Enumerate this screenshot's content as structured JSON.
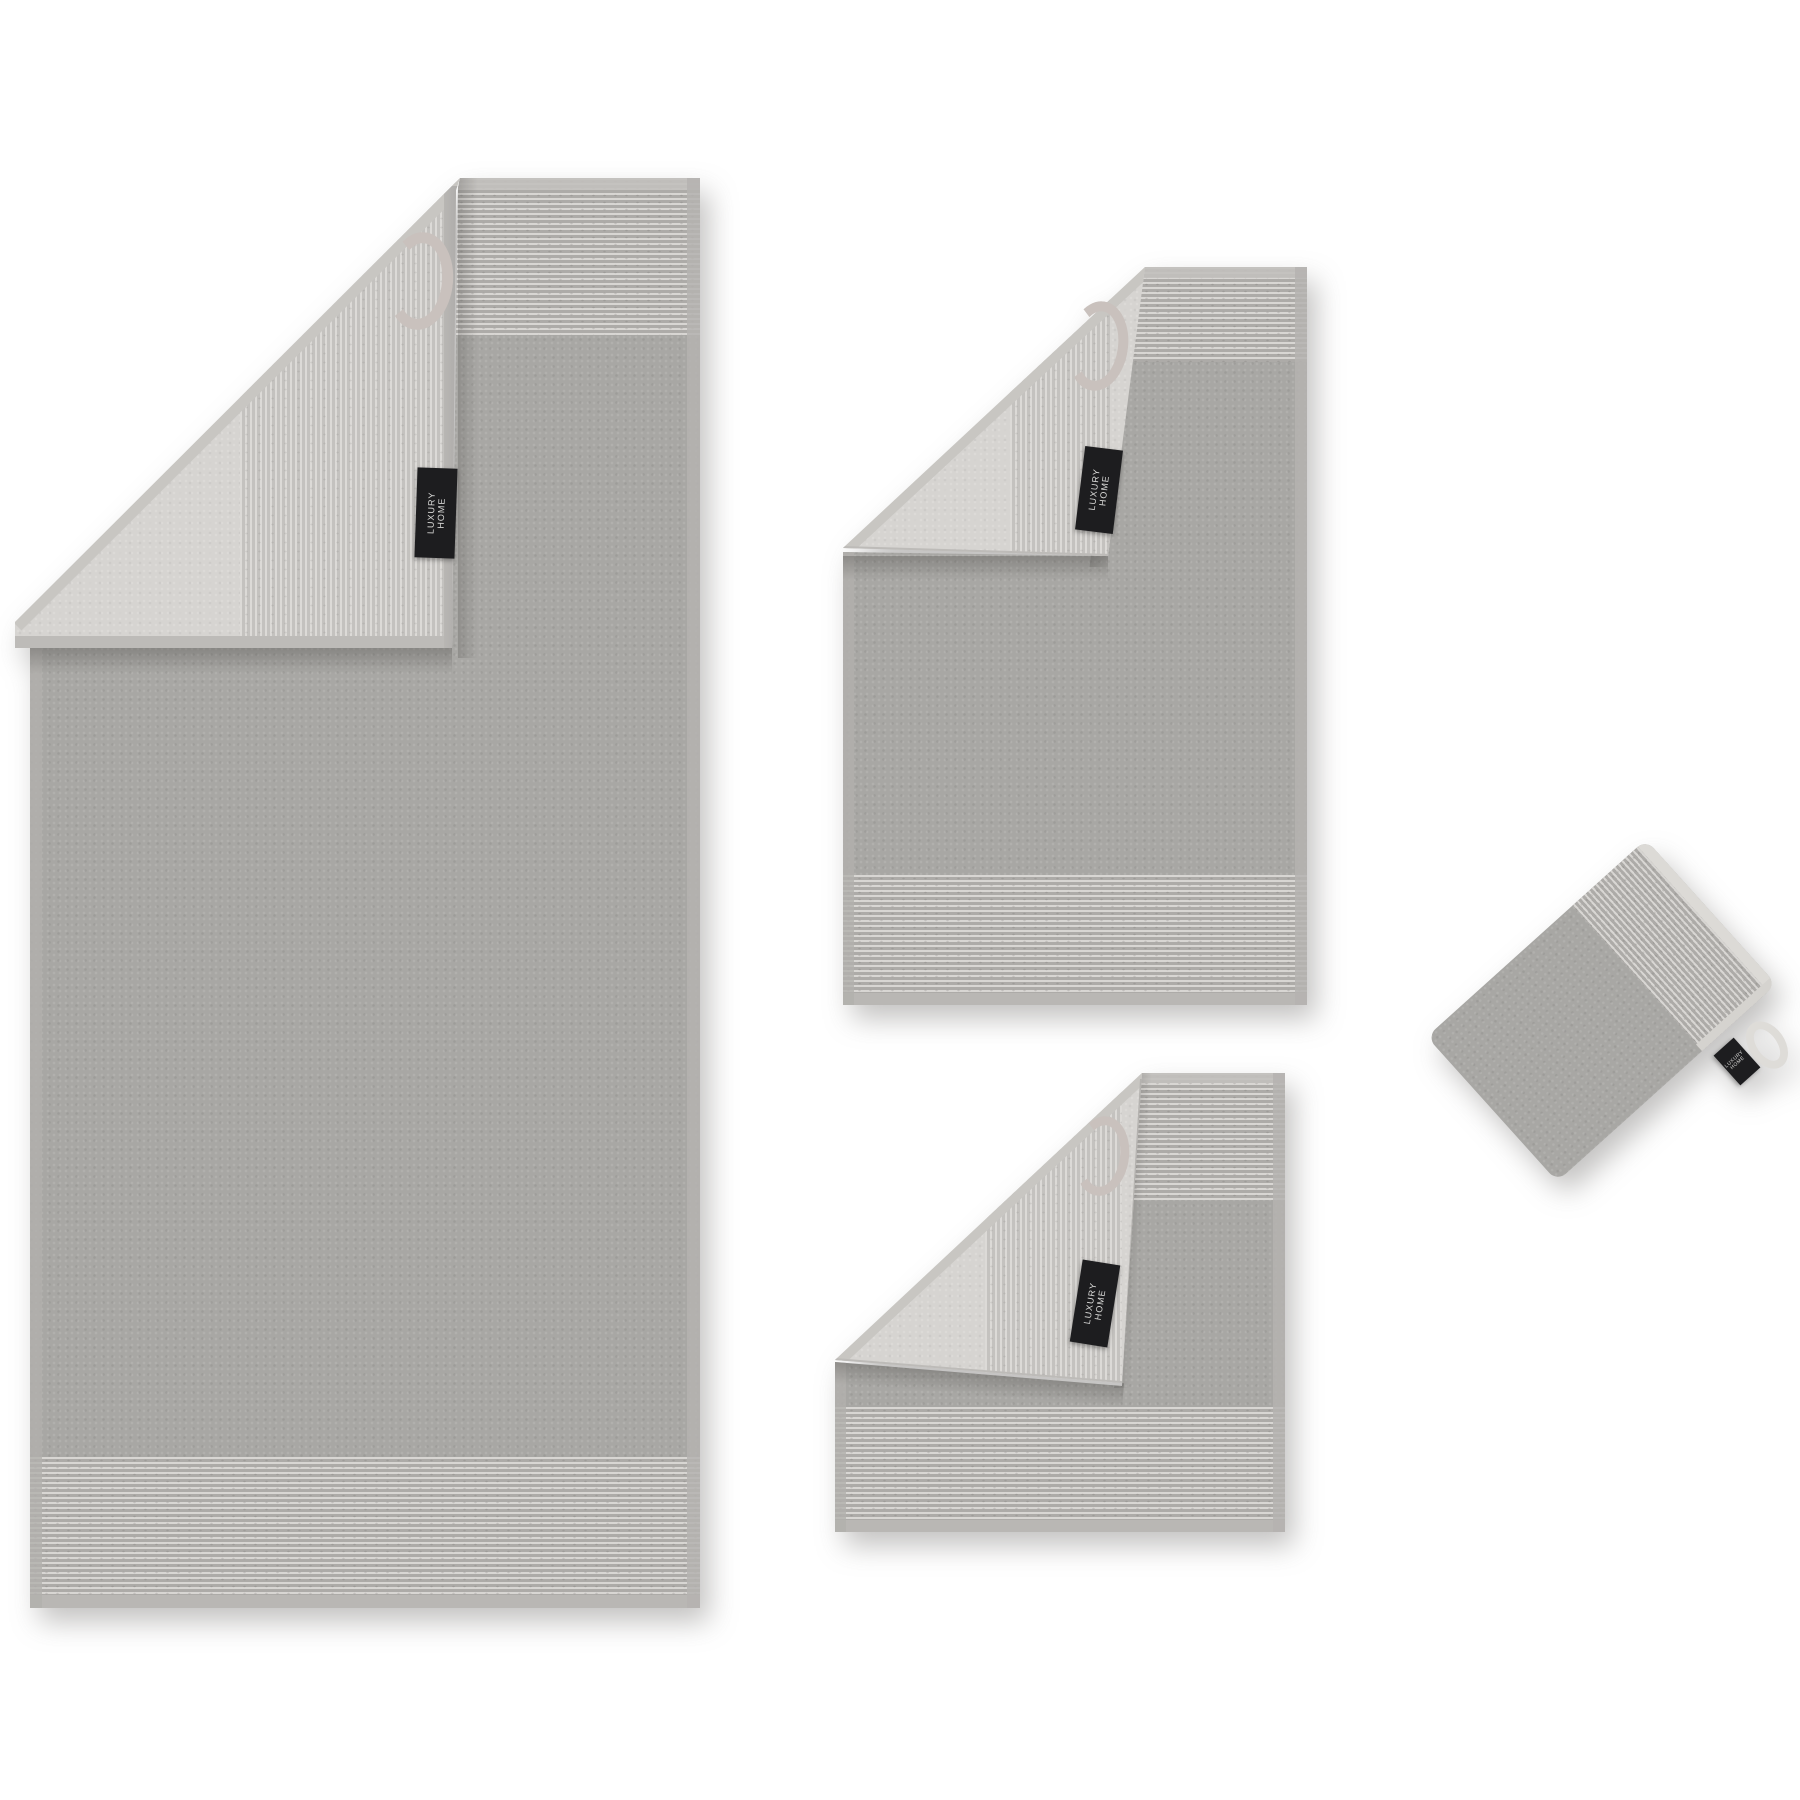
{
  "label": {
    "line1": "LUXURY",
    "line2": "HOME"
  },
  "items": [
    {
      "name": "bath-towel"
    },
    {
      "name": "hand-towel"
    },
    {
      "name": "guest-towel"
    },
    {
      "name": "wash-mitt"
    }
  ],
  "colors": {
    "background": "#ffffff",
    "terry_front": "#a8a7a4",
    "rib_band_light": "#d8d6d3",
    "rib_band_mid": "#adaba8",
    "reverse_side": "#d6d4d1",
    "reverse_rib_light": "#dcdad7",
    "reverse_rib_mid": "#c4c2bf",
    "edging": "#b5b3b0",
    "edging_light": "#c8c6c2",
    "hanging_loop": "#c9c1bd",
    "mitt_cuff_edge": "#dcdad6",
    "label_bg": "#1d1d1f",
    "label_text": "#dcdcda"
  }
}
